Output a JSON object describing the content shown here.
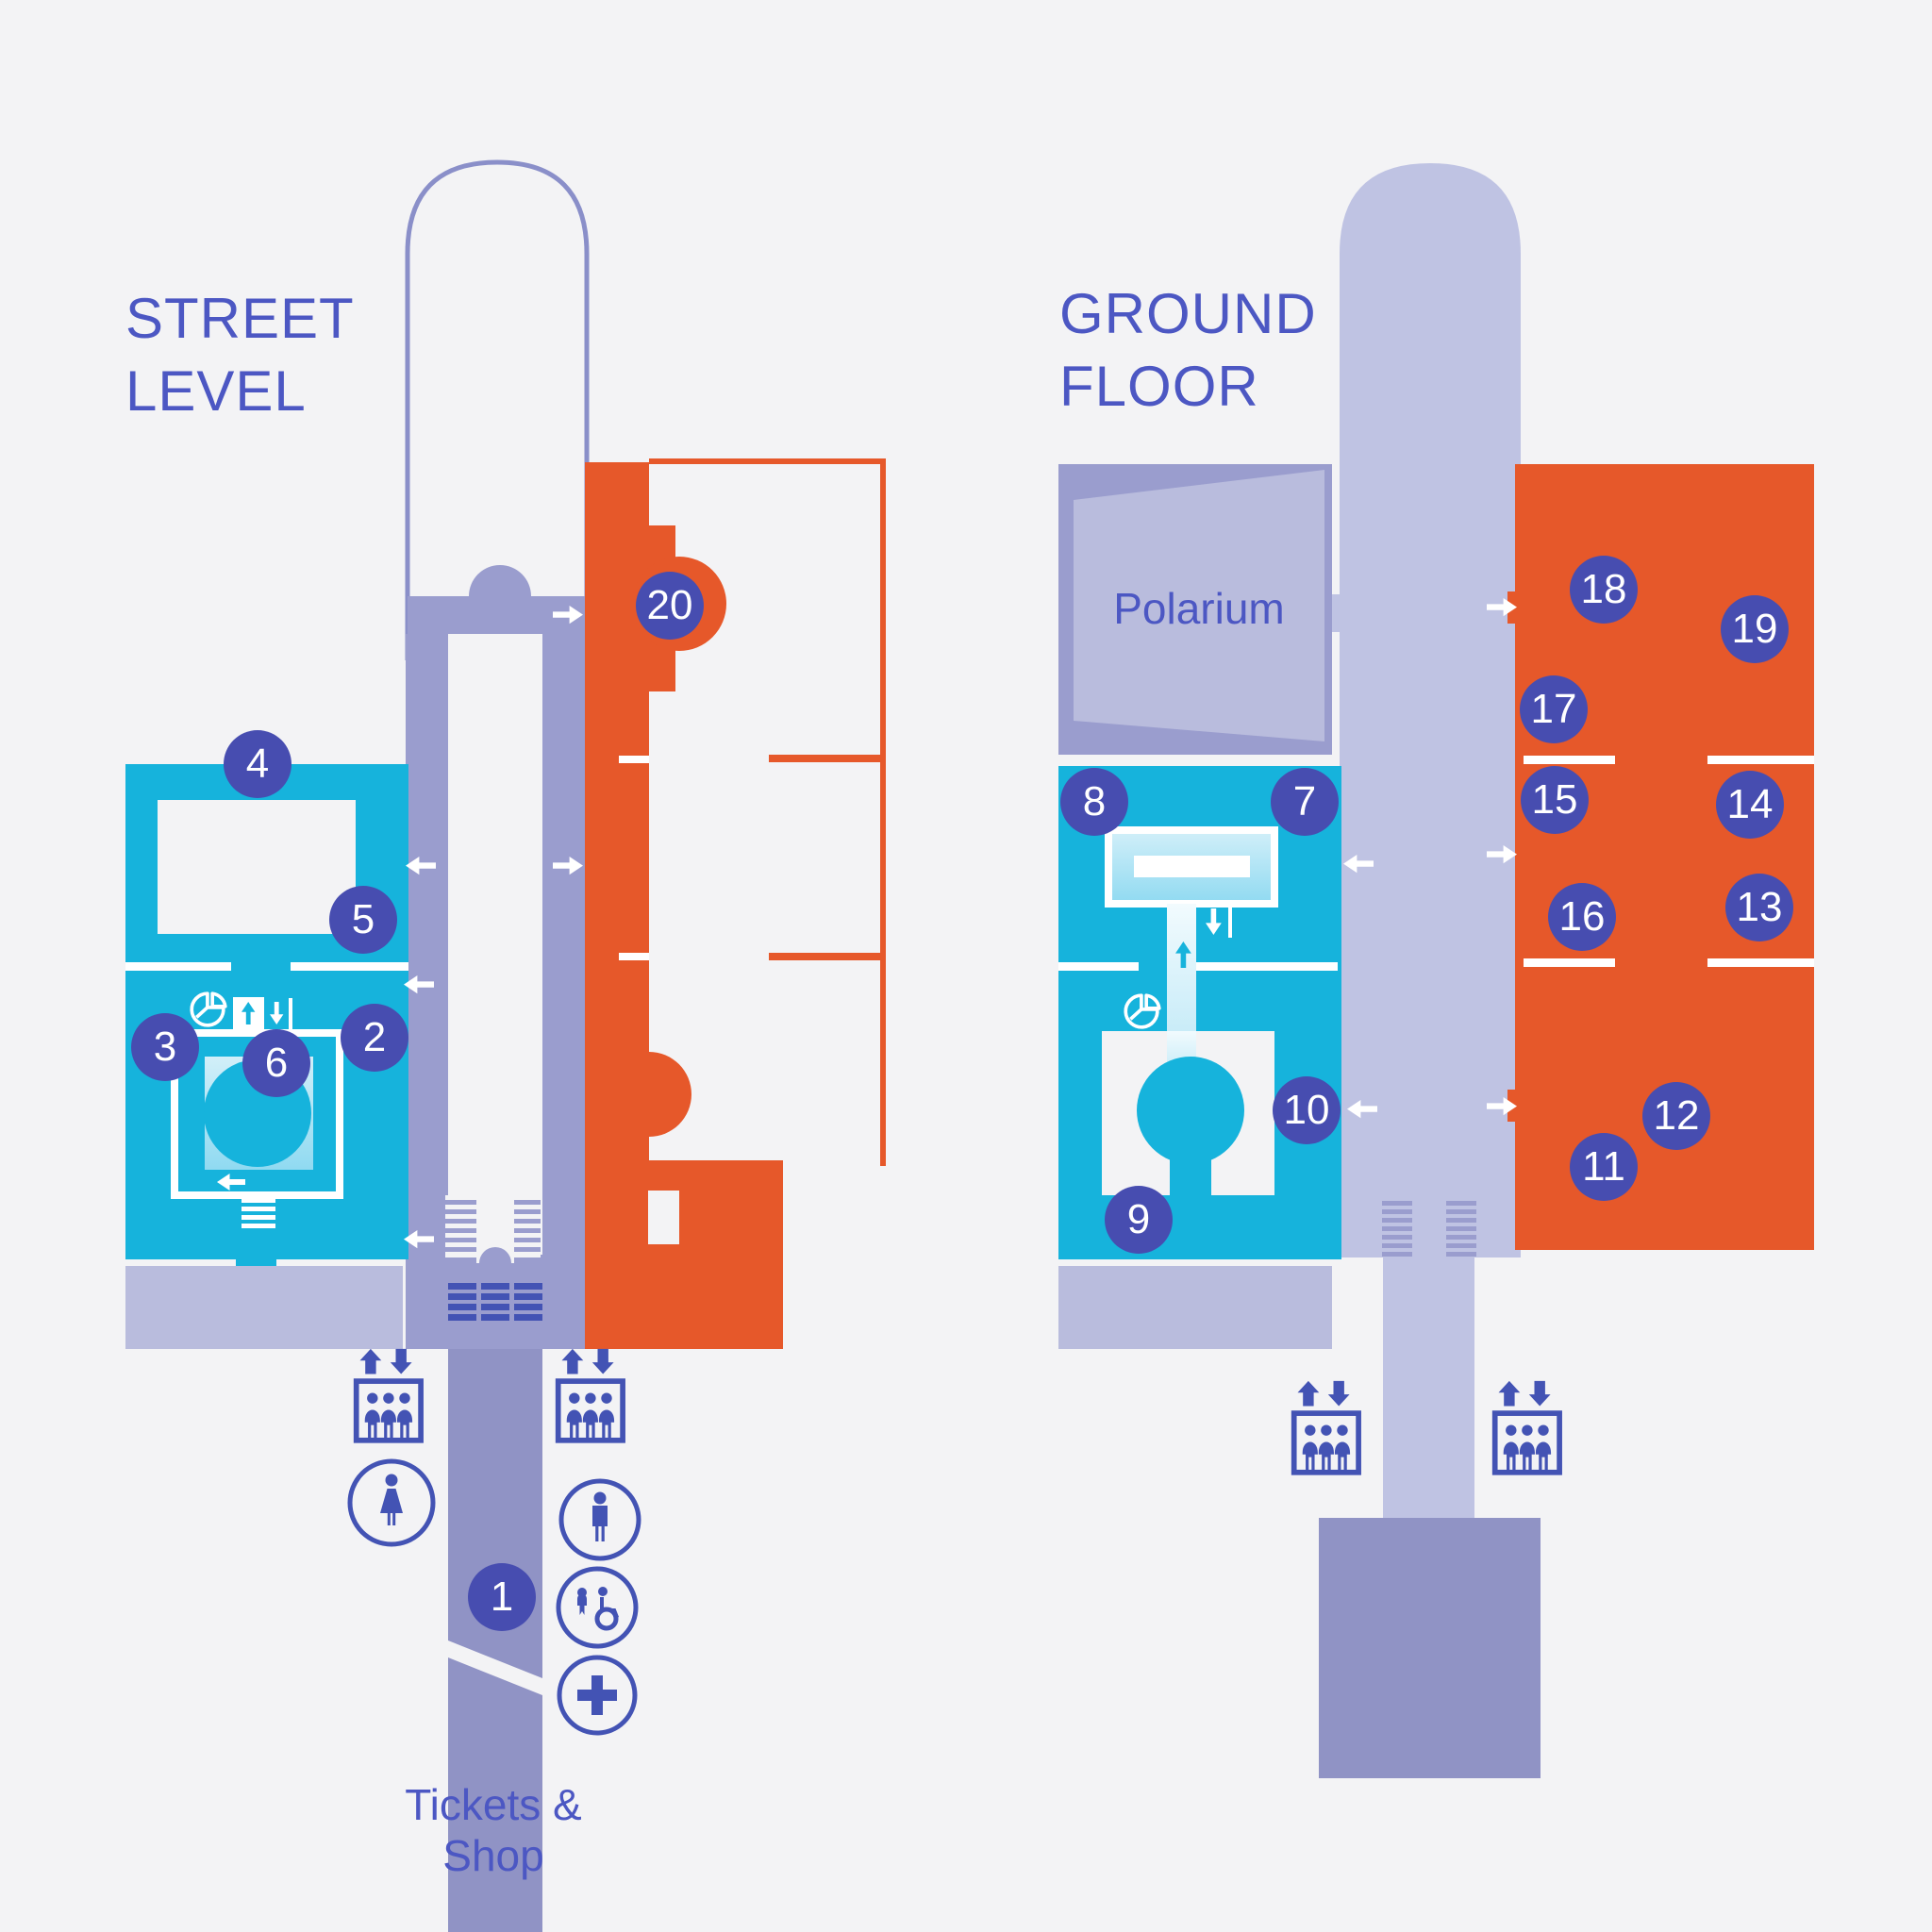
{
  "palette": {
    "bg": "#f3f3f5",
    "ink": "#4c57c3",
    "marker": "#474db0",
    "orange": "#e6582a",
    "cyan": "#16b3dc",
    "mid": "#9a9dce",
    "light": "#b9bcdd",
    "corr": "#bfc3e3",
    "dark": "#9093c5",
    "arch": "#8a8fc9",
    "blue": "#4353b4"
  },
  "street_level": {
    "title": "STREET\nLEVEL",
    "tickets_shop": "Tickets & Shop",
    "markers": {
      "1": "1",
      "2": "2",
      "3": "3",
      "4": "4",
      "5": "5",
      "6": "6",
      "20": "20"
    }
  },
  "ground_floor": {
    "title": "GROUND\nFLOOR",
    "label_polarium": "Polarium",
    "markers": {
      "7": "7",
      "8": "8",
      "9": "9",
      "10": "10",
      "11": "11",
      "12": "12",
      "13": "13",
      "14": "14",
      "15": "15",
      "16": "16",
      "17": "17",
      "18": "18",
      "19": "19"
    }
  },
  "icons": [
    "elevator-icon",
    "toilet-women-icon",
    "toilet-men-icon",
    "baby-change-accessible-icon",
    "first-aid-icon",
    "stairs-icon",
    "turnstiles-icon",
    "pie-icon",
    "direction-arrow-icon"
  ]
}
